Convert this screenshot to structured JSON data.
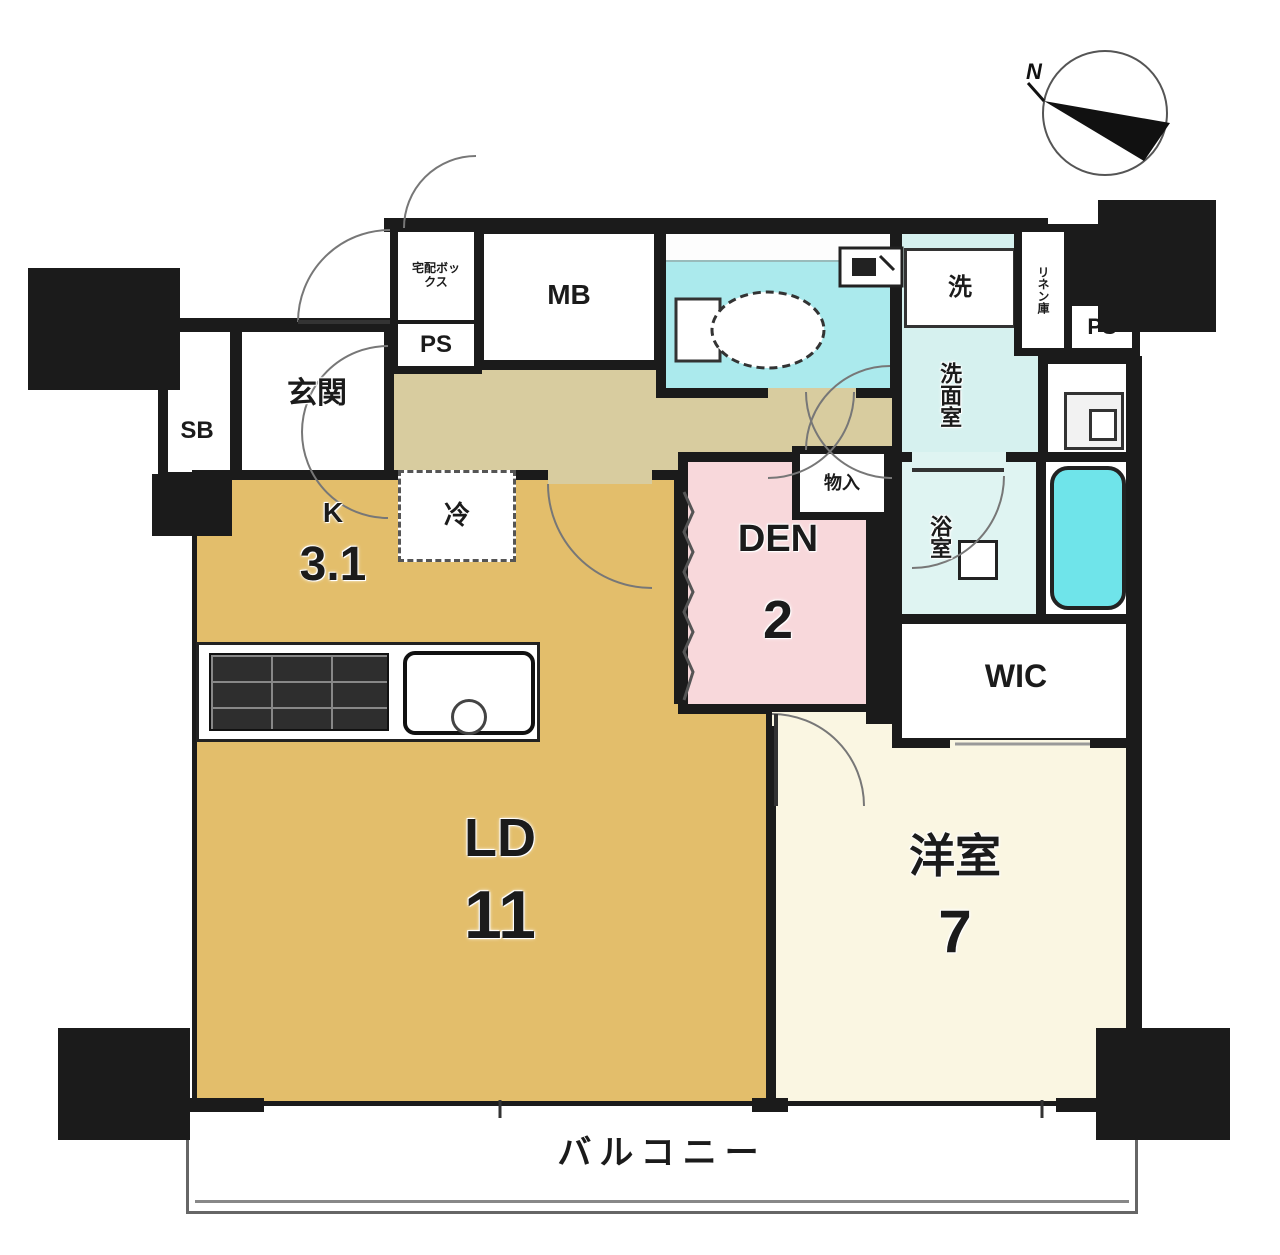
{
  "compass": {
    "label": "N"
  },
  "rooms": {
    "entrance": {
      "label": "玄関"
    },
    "shoe_box": {
      "label": "SB"
    },
    "delivery_box": {
      "label": "宅配ボックス"
    },
    "pipe_space_left": {
      "label": "PS"
    },
    "pipe_space_right": {
      "label": "PS"
    },
    "meter_box": {
      "label": "MB"
    },
    "washing_machine": {
      "label": "洗"
    },
    "washroom": {
      "label": "洗面室"
    },
    "linen": {
      "label": "リネン庫"
    },
    "bathroom": {
      "label": "浴室"
    },
    "storage": {
      "label": "物入"
    },
    "den": {
      "label": "DEN",
      "size": "2"
    },
    "wic": {
      "label": "WIC"
    },
    "kitchen": {
      "label": "K",
      "size": "3.1"
    },
    "refrigerator": {
      "label": "冷"
    },
    "living_dining": {
      "label": "LD",
      "size": "11"
    },
    "western_room": {
      "label": "洋室",
      "size": "7"
    },
    "balcony": {
      "label": "バルコニー"
    }
  },
  "colors": {
    "wall": "#1b1b1b",
    "ldk_floor": "#E3BE6B",
    "hall_floor": "#D8CC9F",
    "western_floor": "#FAF6E2",
    "den_floor": "#F8D8DB",
    "toilet_floor": "#ABEAED",
    "washroom_floor": "#D6F1EF",
    "bath_floor": "#DFF4F2",
    "bathtub": "#6FE4EA"
  }
}
